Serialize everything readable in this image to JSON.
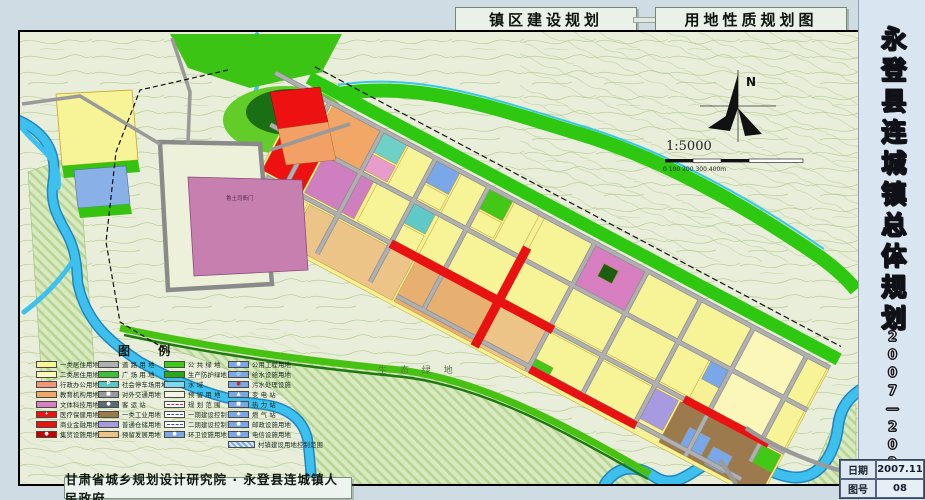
{
  "header": {
    "title_left": "镇区建设规划",
    "title_right": "用地性质规划图"
  },
  "sidebar": {
    "title_vertical": "永登县连城镇总体规划",
    "years_vertical": "2007—2020",
    "date_label": "日期",
    "date_value": "2007.11",
    "sheet_label": "图号",
    "sheet_value": "08"
  },
  "footer": {
    "credit": "甘肃省城乡规划设计研究院 · 永登县连城镇人民政府"
  },
  "map": {
    "landmark_label": "鲁土司衙门",
    "eco_label": "生 态 绿 地",
    "compass_n": "N",
    "scale_text": "1:5000",
    "scale_ticks": "0   100   200   300  400m"
  },
  "colors": {
    "residential1": "#f7f397",
    "residential2": "#fbf7b8",
    "commercial_red": "#ee1111",
    "industrial_brown": "#9c7a4e",
    "warehouse_purple": "#a79ae0",
    "green_public": "#2ec810",
    "water_blue": "#3ec0ee",
    "road_gray": "#b0b0b0"
  },
  "legend": {
    "title": "图  例",
    "columns": [
      {
        "items": [
          {
            "label": "一类居住用地",
            "fill": "#f7f397"
          },
          {
            "label": "二类居住用地",
            "fill": "#fbf7b8"
          },
          {
            "label": "行政办公用地",
            "fill": "#f0957a"
          },
          {
            "label": "教育机构用地",
            "fill": "#f2a766"
          },
          {
            "label": "文体科技用地",
            "fill": "#d77fc0"
          },
          {
            "label": "医疗保健用地",
            "fill": "#ee1111",
            "glyph": "+",
            "glyphColor": "#ffffff"
          },
          {
            "label": "商业金融用地",
            "fill": "#e81212"
          },
          {
            "label": "集贸设施用地",
            "fill": "#c40000",
            "glyph": "●",
            "glyphColor": "#ffffff"
          }
        ]
      },
      {
        "items": [
          {
            "label": "道 路 用 地",
            "fill": "#b0b0b0"
          },
          {
            "label": "广 场 用 地",
            "fill": "#3dbf3d",
            "pattern": "dots"
          },
          {
            "label": "社会停车场用地",
            "fill": "#59c7c7",
            "glyph": "P",
            "glyphColor": "#ffffff"
          },
          {
            "label": "对外交通用地",
            "fill": "#9a9aa2",
            "glyph": "■",
            "glyphColor": "#ffffff"
          },
          {
            "label": "客 运 站",
            "fill": "#5a6a7a",
            "glyph": "●",
            "glyphColor": "#ffffff"
          },
          {
            "label": "一类工业用地",
            "fill": "#9c7a4e"
          },
          {
            "label": "普通仓储用地",
            "fill": "#a79ae0"
          },
          {
            "label": "预留发展用地",
            "fill": "#ecc488"
          }
        ]
      },
      {
        "items": [
          {
            "label": "公 共 绿 地",
            "fill": "#3ecb17"
          },
          {
            "label": "生产防护绿地",
            "fill": "#28a81e"
          },
          {
            "label": "水       域",
            "fill": "#7fd8ef"
          },
          {
            "label": "预 留 用 地",
            "fill": "#f4f4e6"
          },
          {
            "label": "规 划 范 围",
            "fill": "#ffffff",
            "line": "dashed",
            "lineColor": "#e02020"
          },
          {
            "label": "一期建设控制范围",
            "fill": "#ffffff",
            "line": "dashed",
            "lineColor": "#2050d0"
          },
          {
            "label": "二期建设控制范围",
            "fill": "#ffffff",
            "line": "dashed",
            "lineColor": "#2050d0"
          },
          {
            "label": "环卫设施用地",
            "fill": "#7aa7e8",
            "glyph": "●",
            "glyphColor": "#ffffff"
          }
        ]
      },
      {
        "items": [
          {
            "label": "公用工程用地",
            "fill": "#7aa7e8",
            "glyph": "●",
            "glyphColor": "#ffffff"
          },
          {
            "label": "给水设施用地",
            "fill": "#7aa7e8",
            "glyph": "◎",
            "glyphColor": "#ffffff"
          },
          {
            "label": "污水处理设施",
            "fill": "#7aa7e8",
            "glyph": "●",
            "glyphColor": "#c03030"
          },
          {
            "label": "变 电 站",
            "fill": "#7aa7e8",
            "glyph": "▲",
            "glyphColor": "#ffffff"
          },
          {
            "label": "热 力 站",
            "fill": "#7aa7e8",
            "glyph": "■",
            "glyphColor": "#ffffff"
          },
          {
            "label": "燃 气 站",
            "fill": "#7aa7e8",
            "glyph": "◆",
            "glyphColor": "#ffffff"
          },
          {
            "label": "邮政设施用地",
            "fill": "#7aa7e8",
            "glyph": "●",
            "glyphColor": "#ffffff"
          },
          {
            "label": "电信设施用地",
            "fill": "#7aa7e8",
            "glyph": "●",
            "glyphColor": "#ffffff"
          },
          {
            "label": "村镇建设用地控制范围",
            "fill": "hatch-blue",
            "wide": true
          }
        ]
      }
    ]
  }
}
